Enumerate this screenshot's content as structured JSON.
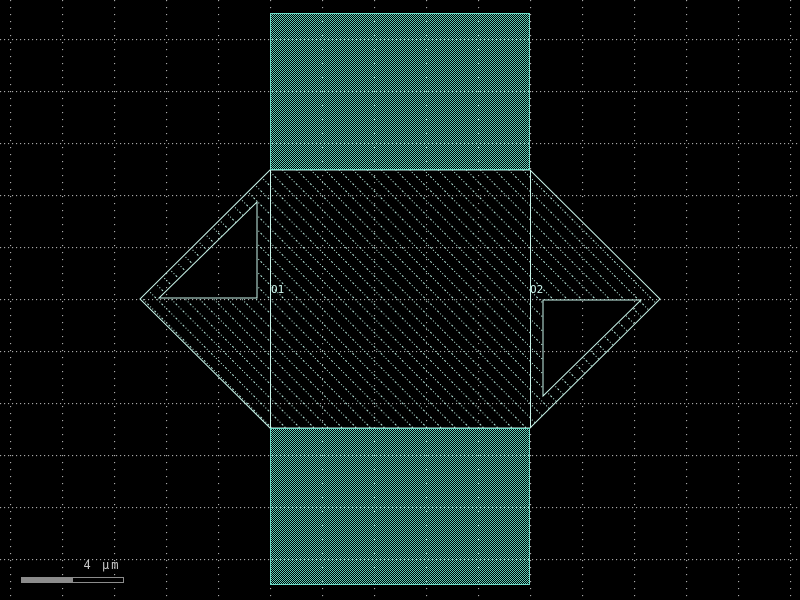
{
  "canvas": {
    "background_color": "#000000",
    "grid": {
      "dot_color": "#a8a8a8",
      "spacing_px": 52,
      "style": "dotted-lines"
    }
  },
  "layers": {
    "teal_dither": {
      "name": "teal-dithered-layer",
      "color": "#5ecfba",
      "border_color": "#6fdcc8",
      "fill_style": "checkerboard-dither"
    },
    "cyan_hatch": {
      "name": "cyan-hatched-layer",
      "color": "#bff2e6",
      "border_color": "#c9f5ea",
      "fill_style": "diagonal-dotted-hatch"
    }
  },
  "labels": {
    "o1": "O1",
    "o2": "O2",
    "label_color": "#cdf6ec"
  },
  "scalebar": {
    "label": "4 µm",
    "bar_color": "#8c8c8c",
    "text_color": "#c8c8c8"
  }
}
